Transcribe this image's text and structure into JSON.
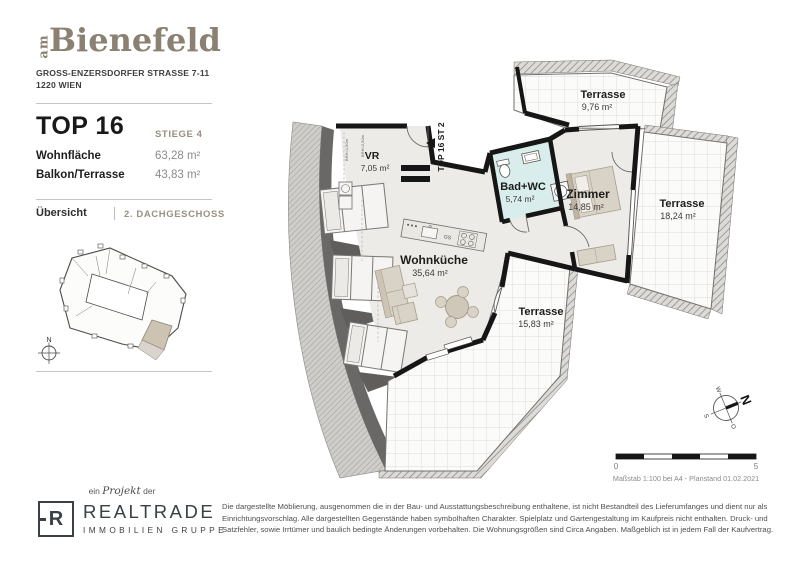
{
  "sidebar": {
    "logo": {
      "prefix": "am",
      "name": "Bienefeld"
    },
    "address": [
      "GROSS-ENZERSDORFER STRASSE 7-11",
      "1220 WIEN"
    ],
    "unit": {
      "title": "TOP 16",
      "stiege": "STIEGE 4"
    },
    "metrics": [
      {
        "label": "Wohnfläche",
        "value": "63,28 m²"
      },
      {
        "label": "Balkon/Terrasse",
        "value": "43,83 m²"
      }
    ],
    "tabs": {
      "overview": "Übersicht",
      "floor": "2. DACHGESCHOSS"
    },
    "site_plan_north": "N"
  },
  "plan": {
    "entrance_label": "TOP 16 ST 2",
    "rooms": [
      {
        "name": "VR",
        "area": "7,05 m²"
      },
      {
        "name": "Bad+WC",
        "area": "5,74 m²"
      },
      {
        "name": "Zimmer",
        "area": "14,85 m²"
      },
      {
        "name": "Wohnküche",
        "area": "35,64 m²"
      },
      {
        "name": "Terrasse",
        "area": "9,76 m²"
      },
      {
        "name": "Terrasse",
        "area": "18,24 m²"
      },
      {
        "name": "Terrasse",
        "area": "15,83 m²"
      }
    ],
    "kitchen_dishwasher_label": "GS",
    "dimension_labels": [
      "BRH=1,50m",
      "BRH=2,50m"
    ],
    "compass": {
      "n": "N",
      "e": "O",
      "s": "S",
      "w": "W"
    },
    "scale": {
      "start": "0",
      "end": "5",
      "caption": "Maßstab 1:100 bei A4 - Planstand 01.02.2021"
    }
  },
  "footer": {
    "project_line": {
      "pre": "ein",
      "word": "Projekt",
      "post": "der"
    },
    "logo": {
      "letter": "R",
      "name": "REALTRADE",
      "subtitle": "IMMOBILIEN GRUPPE"
    },
    "disclaimer": "Die dargestellte Möblierung, ausgenommen die in der Bau- und Ausstattungsbeschreibung enthaltene, ist nicht Bestandteil des Lieferumfanges und dient nur als Einrichtungsvorschlag. Alle dargestellten Gegenstände haben symbolhaften Charakter. Spielplatz und Gartengestaltung im Kaufpreis nicht enthalten. Druck- und Satzfehler, sowie Irrtümer und baulich bedingte Änderungen vorbehalten. Die Wohnungsgrößen sind Circa Angaben. Maßgeblich ist in jedem Fall der Kaufvertrag."
  },
  "colors": {
    "brand": "#8a8172",
    "wall": "#161616",
    "bath_room": "#d8edec",
    "floor": "#edebe7",
    "unit_highlight": "#cdc3b2"
  }
}
